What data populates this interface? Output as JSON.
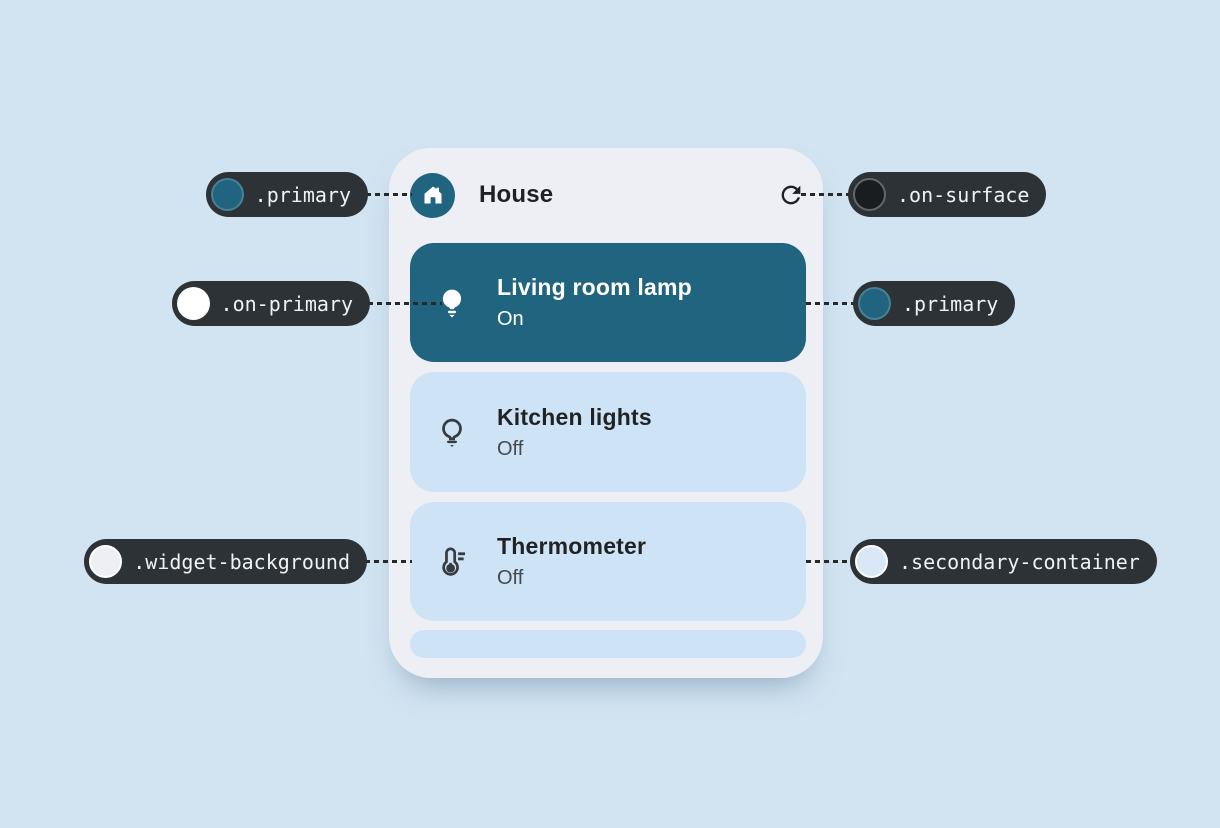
{
  "widget": {
    "title": "House",
    "devices": [
      {
        "name": "Living room lamp",
        "status": "On",
        "icon": "lamp-on-icon"
      },
      {
        "name": "Kitchen lights",
        "status": "Off",
        "icon": "lamp-off-icon"
      },
      {
        "name": "Thermometer",
        "status": "Off",
        "icon": "thermometer-icon"
      }
    ],
    "header_icons": {
      "left": "home-icon",
      "right": "refresh-icon"
    }
  },
  "callouts": [
    {
      "label": ".primary",
      "swatch": "#20647f",
      "ring": "rgba(255,255,255,0.18)"
    },
    {
      "label": ".on-surface",
      "swatch": "#1a1d20",
      "ring": "#62676b"
    },
    {
      "label": ".on-primary",
      "swatch": "#ffffff",
      "ring": "rgba(255,255,255,0.45)"
    },
    {
      "label": ".primary",
      "swatch": "#20647f",
      "ring": "rgba(255,255,255,0.18)"
    },
    {
      "label": ".widget-background",
      "swatch": "#edeff4",
      "ring": "#ffffff"
    },
    {
      "label": ".secondary-container",
      "swatch": "#d9e7f6",
      "ring": "#ffffff"
    }
  ],
  "colors": {
    "page_bg": "#d2e4f2",
    "widget_bg": "#edeff4",
    "primary": "#20647f",
    "on_primary": "#ffffff",
    "secondary_container": "#cfe3f6",
    "on_surface": "#1d2124",
    "subtitle_gray": "#45494d",
    "pill_bg": "#2d3236",
    "pill_text": "#eff1f2",
    "connector": "#26292c"
  }
}
